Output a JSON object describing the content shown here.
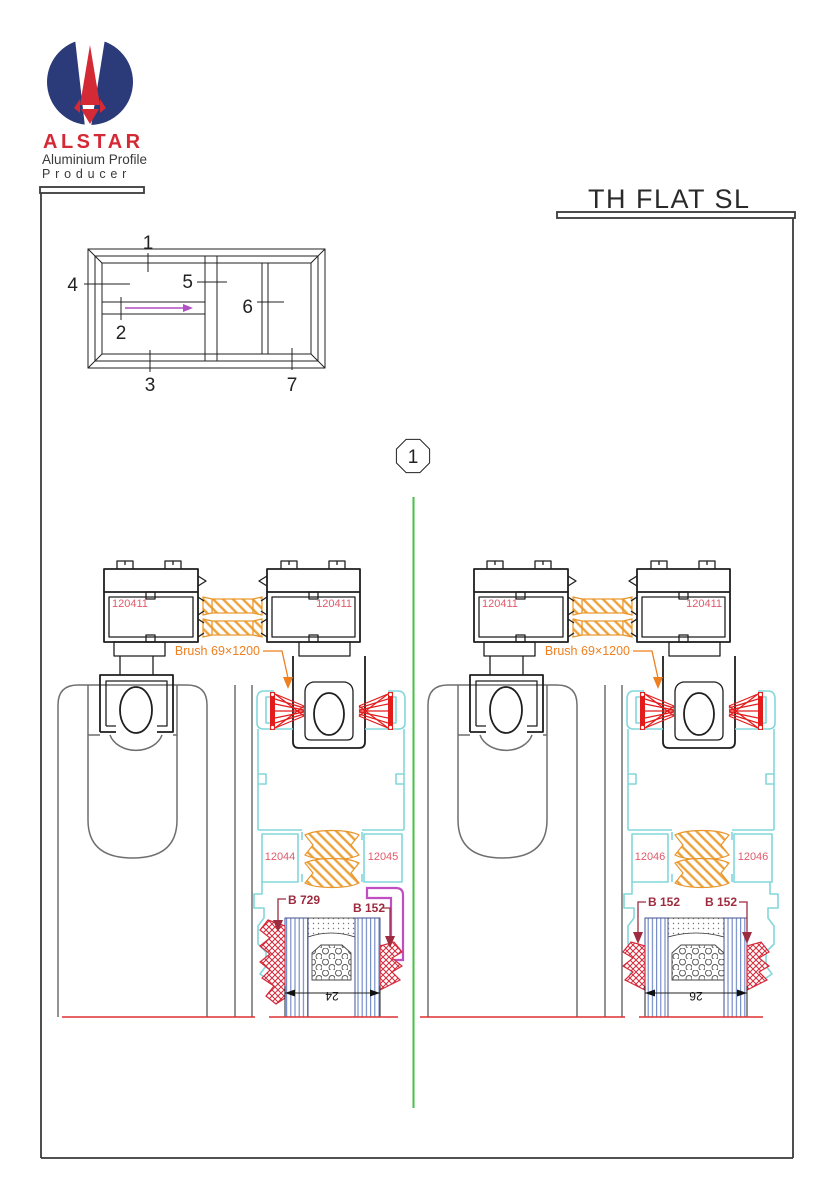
{
  "brand": {
    "name": "ALSTAR",
    "line1": "Aluminium Profile",
    "line2": "Producer"
  },
  "title": "TH FLAT SL",
  "section_marker": "1",
  "schematic": {
    "callouts": [
      "1",
      "2",
      "3",
      "4",
      "5",
      "6",
      "7"
    ]
  },
  "details": [
    {
      "profile_left": "120411",
      "profile_right": "120411",
      "brush_label": "Brush 69×1200",
      "insert_left": "12044",
      "insert_right": "12045",
      "gasket_left": "B 729",
      "gasket_right": "B 152",
      "glass_width": "24"
    },
    {
      "profile_left": "120411",
      "profile_right": "120411",
      "brush_label": "Brush 69×1200",
      "insert_left": "12046",
      "insert_right": "12046",
      "gasket_left": "B 152",
      "gasket_right": "B 152",
      "glass_width": "26"
    }
  ],
  "colors": {
    "brand_navy": "#2b3a78",
    "brand_red": "#d42a35",
    "profile_black": "#1f1f1f",
    "sash_gray": "#6f6f6f",
    "label_red": "#e05a6a",
    "callout_dark_red": "#9e2b3f",
    "thermal_orange": "#e8952a",
    "brush_red": "#e31b1b",
    "frame_cyan": "#82d7dc",
    "hook_magenta": "#bf4fc2",
    "divider_green": "#44c244",
    "glass_blue": "#6b85c4",
    "baseline_red": "#e03030"
  }
}
